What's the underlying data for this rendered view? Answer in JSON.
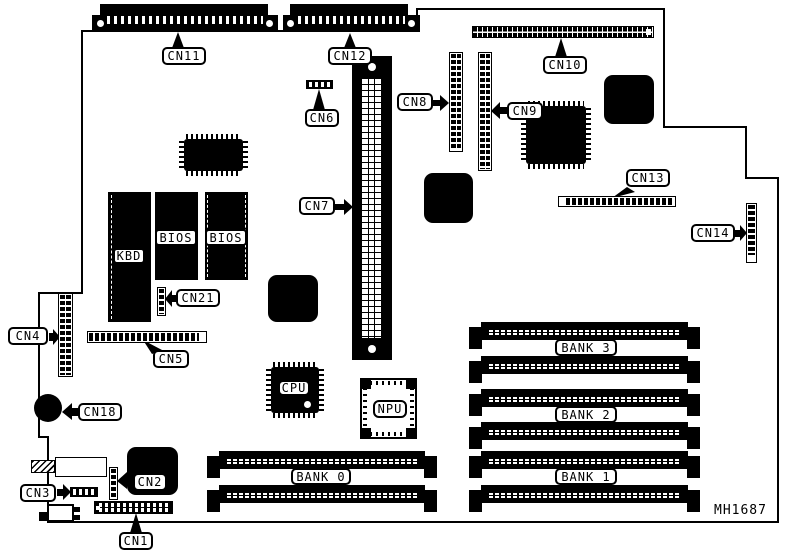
{
  "figure": {
    "part_number": "MH1687"
  },
  "callouts": {
    "cn1": "CN1",
    "cn2": "CN2",
    "cn3": "CN3",
    "cn4": "CN4",
    "cn5": "CN5",
    "cn6": "CN6",
    "cn7": "CN7",
    "cn8": "CN8",
    "cn9": "CN9",
    "cn10": "CN10",
    "cn11": "CN11",
    "cn12": "CN12",
    "cn13": "CN13",
    "cn14": "CN14",
    "cn18": "CN18",
    "cn21": "CN21"
  },
  "chips": {
    "kbd": "KBD",
    "bios1": "BIOS",
    "bios2": "BIOS",
    "cpu": "CPU",
    "npu": "NPU"
  },
  "banks": {
    "bank0": "BANK 0",
    "bank1": "BANK 1",
    "bank2": "BANK 2",
    "bank3": "BANK 3"
  }
}
